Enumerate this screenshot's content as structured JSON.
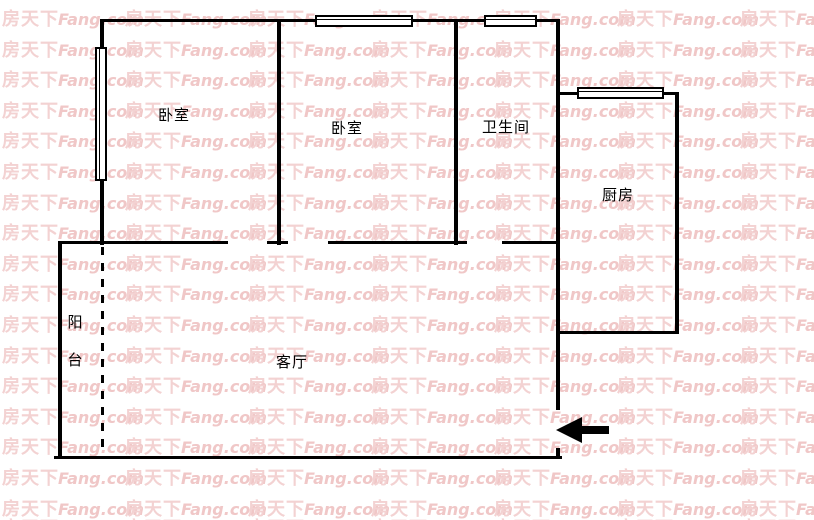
{
  "watermark": {
    "cn": "房天下",
    "en": "Fang.com",
    "cn_color": "#f3d2d2",
    "en_color": "#f0c7c7"
  },
  "rooms": {
    "bedroom_left": {
      "label": "卧室"
    },
    "bedroom_middle": {
      "label": "卧室"
    },
    "bathroom": {
      "label": "卫生间"
    },
    "kitchen": {
      "label": "厨房"
    },
    "balcony": {
      "label": "阳台"
    },
    "living_room": {
      "label": "客厅"
    }
  },
  "entrance": {
    "arrow_direction": "left"
  },
  "colors": {
    "background": "#ffffff",
    "wall": "#000000"
  }
}
